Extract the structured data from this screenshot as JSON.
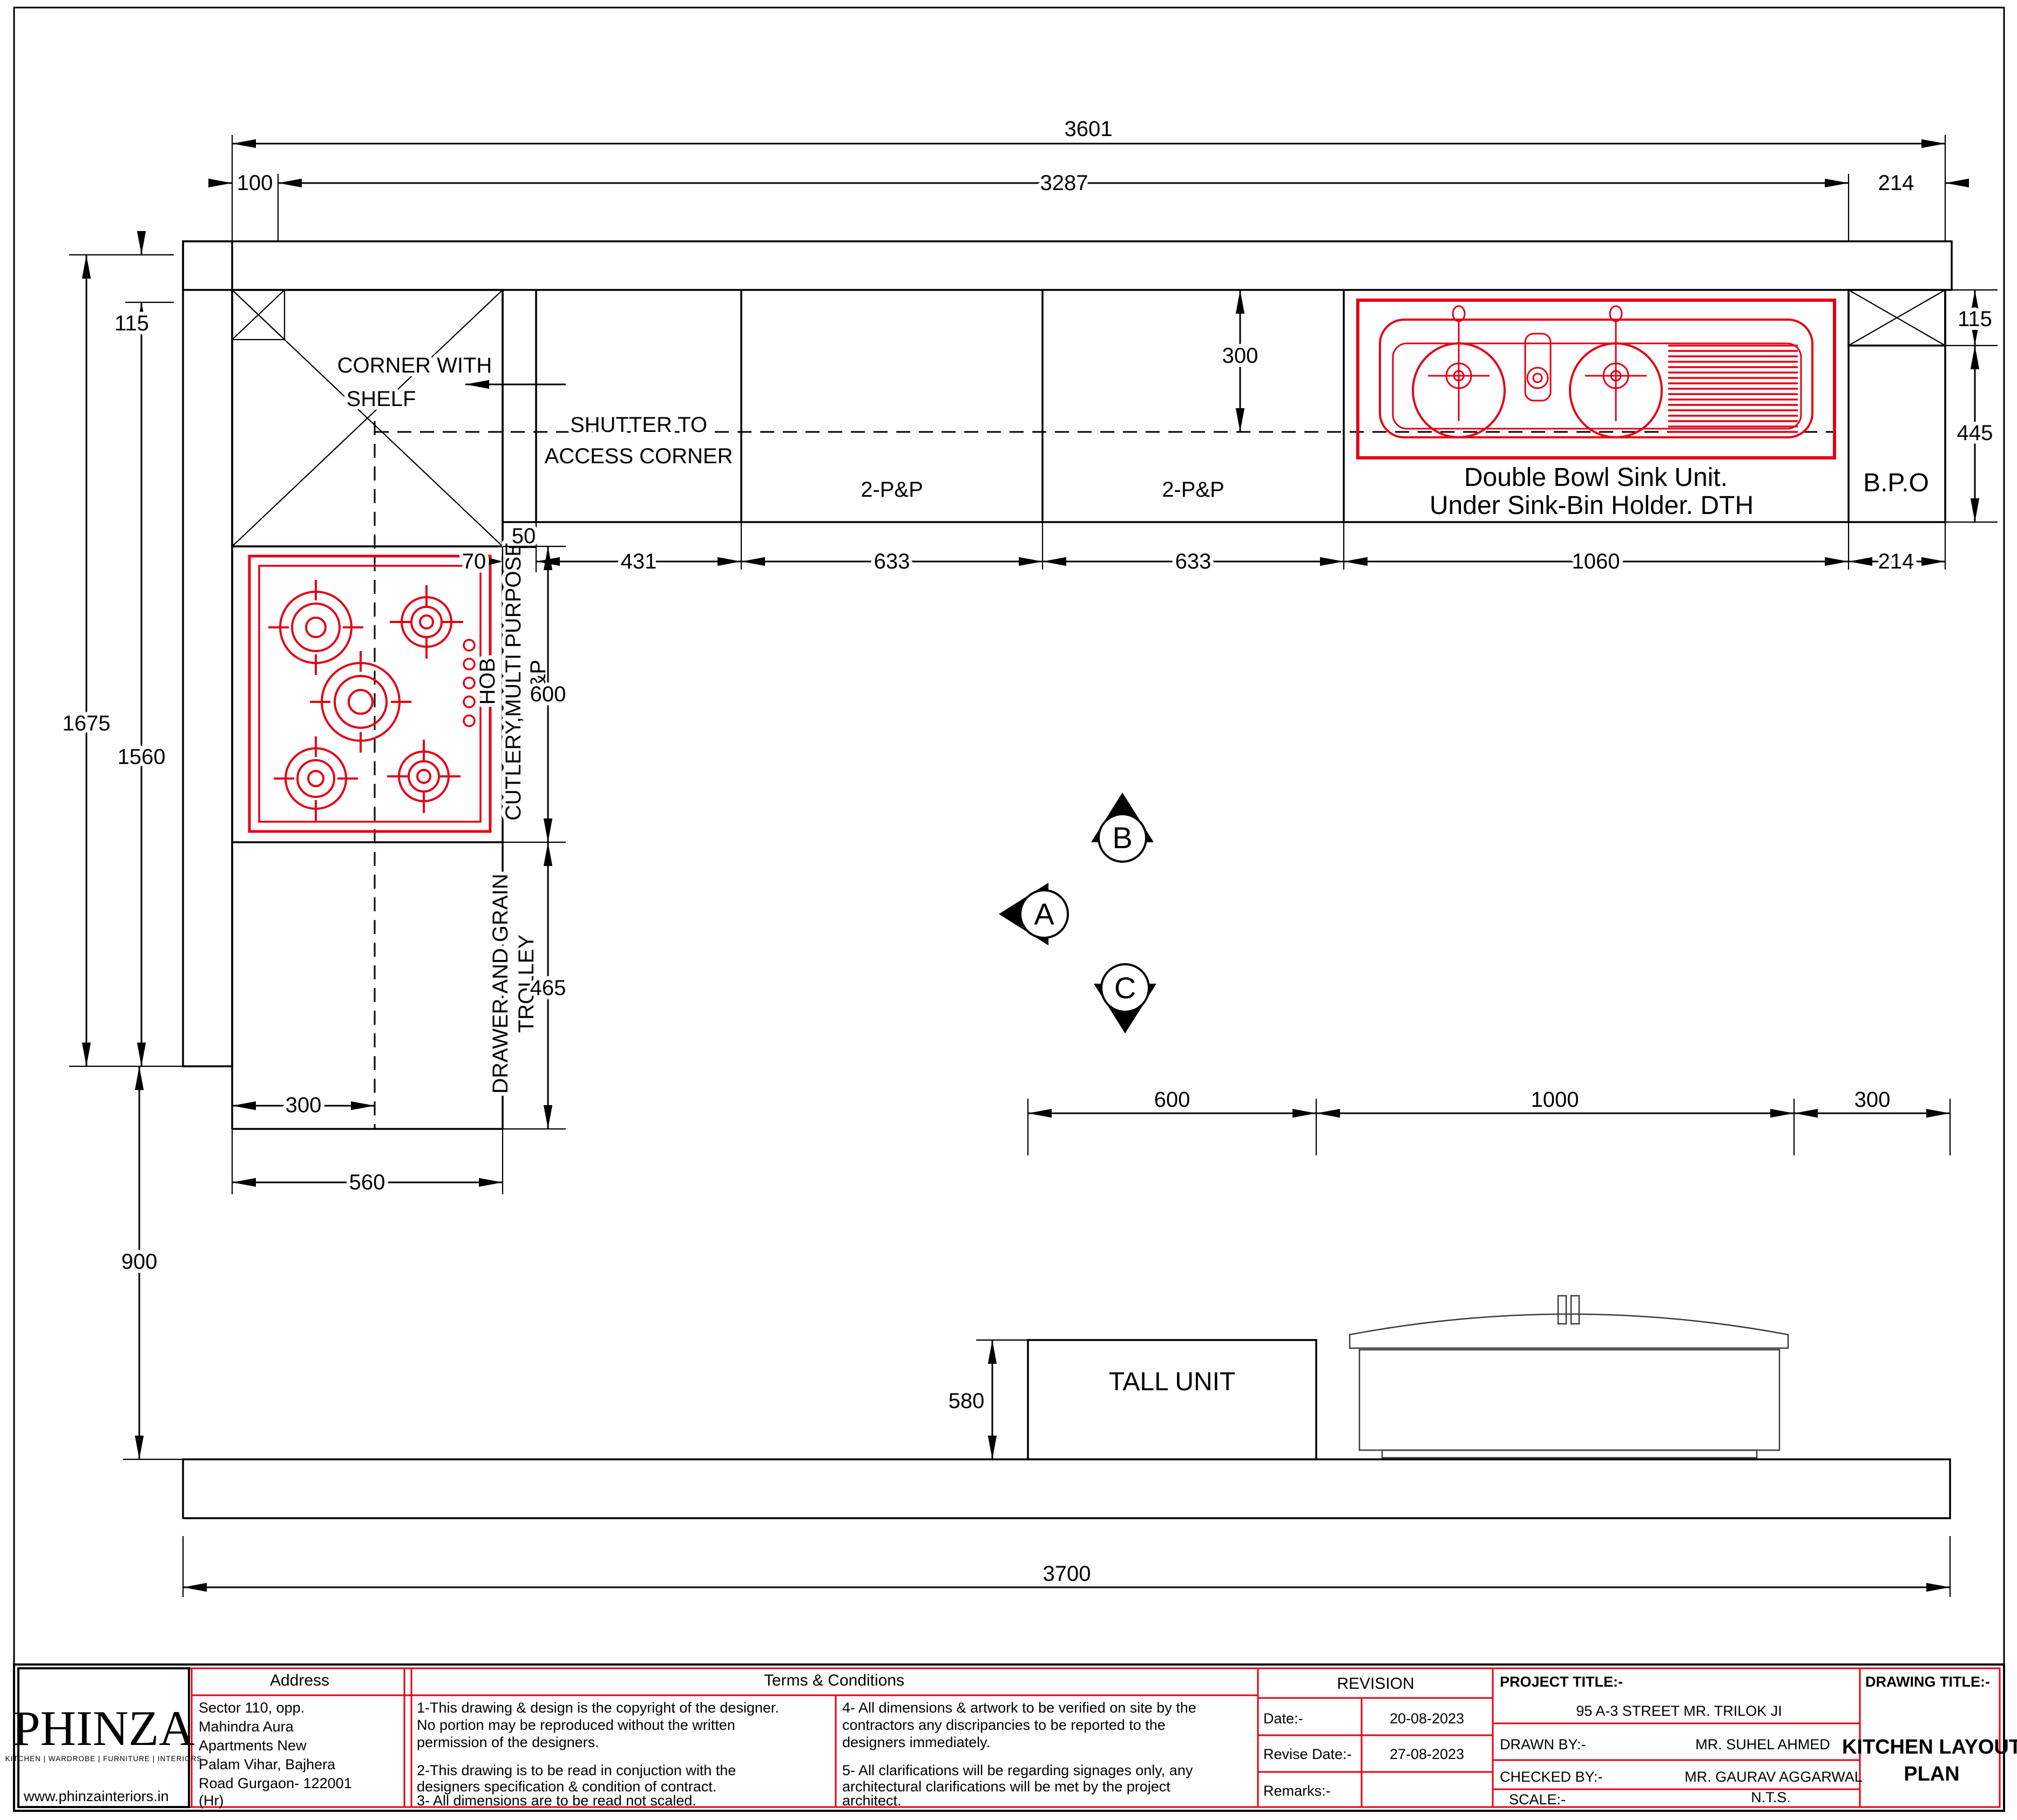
{
  "colors": {
    "accent_red": "#e30016",
    "line_black": "#000000",
    "paper": "#ffffff"
  },
  "d": {
    "overall_top": "3601",
    "top_left": "100",
    "top_mid": "3287",
    "top_right": "214",
    "left_wall": "115",
    "left_outer": "1675",
    "left_inner": "1560",
    "left_lower": "900",
    "right_wall": "115",
    "right_depth": "445",
    "sink_offset": "300",
    "filler_top": "50",
    "filler": "70",
    "shutter": "431",
    "pp1": "633",
    "pp2": "633",
    "sink": "1060",
    "bpo": "214",
    "hob": "600",
    "trolley": "465",
    "hob_offset": "300",
    "left_run": "560",
    "tall": "600",
    "fridge": "1000",
    "gap_right": "300",
    "tall_depth": "580",
    "overall_bottom": "3700"
  },
  "l": {
    "corner1": "CORNER WITH",
    "corner2": "SHELF",
    "shutter1": "SHUTTER TO",
    "shutter2": "ACCESS CORNER",
    "pp1": "2-P&P",
    "pp2": "2-P&P",
    "sink1": "Double Bowl Sink Unit.",
    "sink2": "Under Sink-Bin Holder. DTH",
    "bpo": "B.P.O",
    "hob1": "HOB",
    "hob2": "CUTLERY,MULTI PURPOSE",
    "hob3": "P&P",
    "trolley1": "DRAWER AND GRAIN",
    "trolley2": "TROLLEY",
    "tall": "TALL UNIT",
    "ma": "A",
    "mb": "B",
    "mc": "C"
  },
  "tb": {
    "logo": "PHINZA",
    "tagline": "KITCHEN | WARDROBE | FURNITURE | INTERIORS",
    "site": "www.phinzainteriors.in",
    "address_h": "Address",
    "addr1": "Sector 110, opp.",
    "addr2": "Mahindra Aura",
    "addr3": "Apartments New",
    "addr4": "Palam Vihar, Bajhera",
    "addr5": "Road Gurgaon- 122001",
    "addr6": "(Hr)",
    "terms_h": "Terms & Conditions",
    "t1a": "1-This drawing & design is the copyright of the designer.",
    "t1b": "No portion may be reproduced without the written",
    "t1c": "permission of the designers.",
    "t2a": "2-This drawing is to be read in conjuction with the",
    "t2b": "designers specification & condition of contract.",
    "t3": "3- All dimensions are to be read not scaled.",
    "t4a": "4- All dimensions & artwork to be verified on site by the",
    "t4b": "contractors any discripancies to be reported to the",
    "t4c": "designers immediately.",
    "t5a": "5- All clarifications will be regarding signages only, any",
    "t5b": "architectural clarifications will be met by the project",
    "t5c": "architect.",
    "rev_h": "REVISION",
    "date_l": "Date:-",
    "date_v": "20-08-2023",
    "rev_l": "Revise Date:-",
    "rev_v": "27-08-2023",
    "rem_l": "Remarks:-",
    "pt_l": "PROJECT TITLE:-",
    "pt_v": "95 A-3 STREET MR. TRILOK JI",
    "db_l": "DRAWN BY:-",
    "db_v": "MR. SUHEL AHMED",
    "cb_l": "CHECKED BY:-",
    "cb_v": "MR. GAURAV AGGARWAL",
    "sc_l": "SCALE:-",
    "sc_v": "N.T.S.",
    "dt_l": "DRAWING TITLE:-",
    "dt1": "KITCHEN LAYOUT",
    "dt2": "PLAN"
  }
}
